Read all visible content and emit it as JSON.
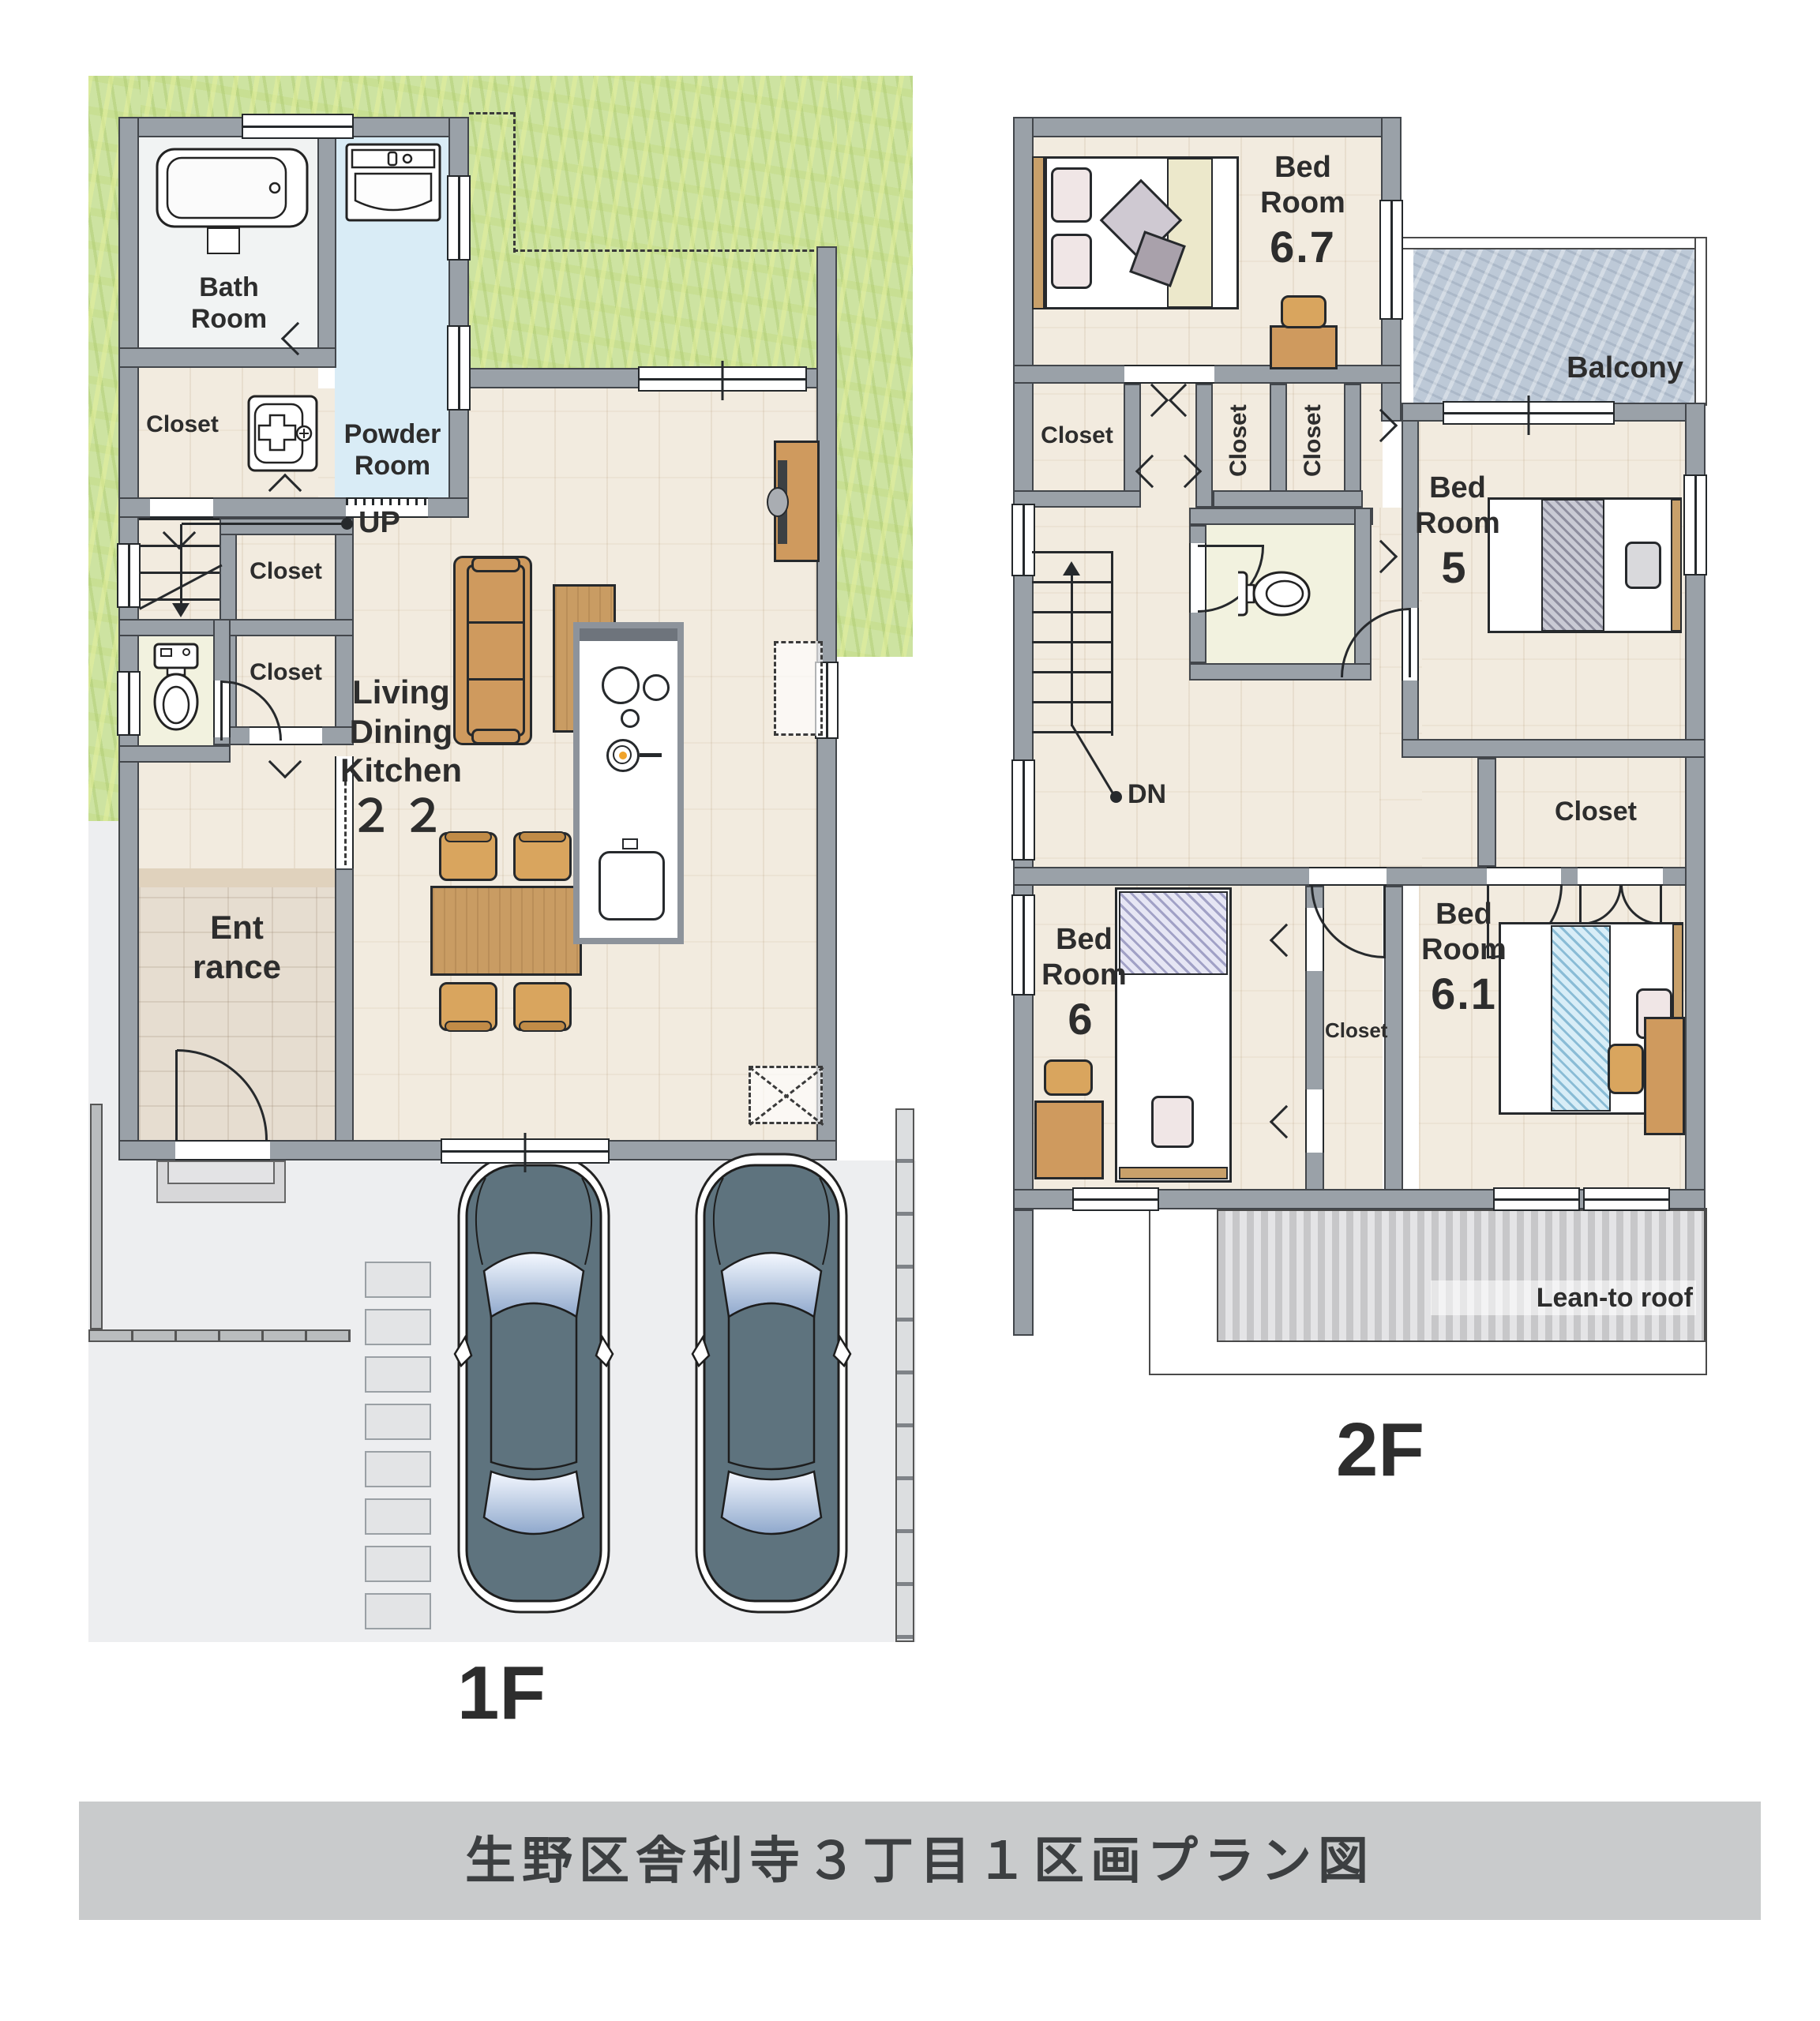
{
  "title": "生野区舎利寺３丁目１区画プラン図",
  "floor1": {
    "label": "1F",
    "rooms": {
      "bath": [
        "Bath",
        "Room"
      ],
      "powder": [
        "Powder",
        "Room"
      ],
      "closet": "Closet",
      "entrance": [
        "Ent",
        "rance"
      ],
      "ldk": [
        "Living",
        "Dining",
        "Kitchen"
      ],
      "ldk_size": "２２",
      "up": "UP"
    }
  },
  "floor2": {
    "label": "2F",
    "rooms": {
      "bed67": [
        "Bed",
        "Room",
        "6.7"
      ],
      "bed5": [
        "Bed",
        "Room",
        "5"
      ],
      "bed6": [
        "Bed",
        "Room",
        "6"
      ],
      "bed61": [
        "Bed",
        "Room",
        "6.1"
      ],
      "closet": "Closet",
      "balcony": "Balcony",
      "leanto": "Lean-to roof",
      "dn": "DN"
    }
  },
  "colors": {
    "lawn": "#cde3a1",
    "wall": "#9aa1a8",
    "powder_floor": "#d9ecf6",
    "wood_floor": "#f2ebdf",
    "balcony": "#bdc9d7",
    "car_body": "#5e737e",
    "furniture_wood": "#cf9a5e",
    "title_bar": "#c9cbcc"
  }
}
